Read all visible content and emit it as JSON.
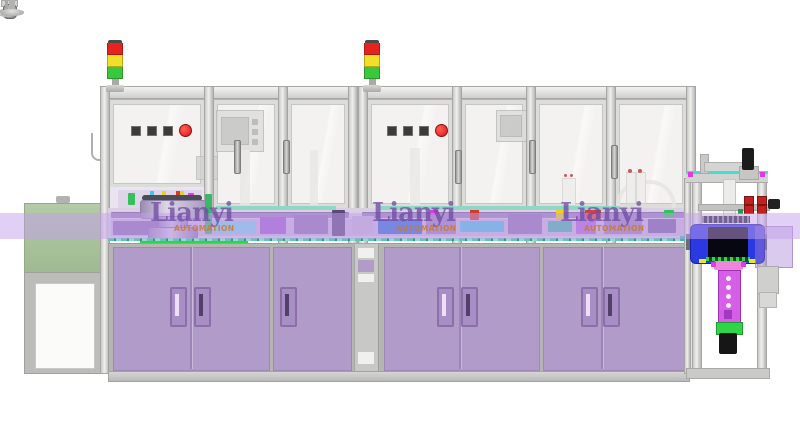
{
  "scene": {
    "description": "3D CAD render of a two-module enclosed automation assembly line: twin red-yellow-green signal towers, glass safety doors with pushbutton panels, vibratory bowl feeder, purple lower cabinets on leveling feet and casters, a left outfeed conveyor cabinet and a right camera inspection station"
  },
  "watermark": {
    "brand": "Lianyi",
    "subtitle": "AUTOMATION",
    "instances": [
      {
        "x": 150,
        "y": 200
      },
      {
        "x": 372,
        "y": 200
      },
      {
        "x": 560,
        "y": 200
      }
    ]
  },
  "palette": {
    "frame_dark": "#a6a6a4",
    "glass": "#f3f2f0",
    "cabinet_purple": "#b19cc9",
    "cabinet_border": "#9d88b6",
    "handle_light": "#eedff8",
    "handle_dark": "#52406b",
    "handle_frame": "#8a6fa8",
    "green_cabinet": "#aac19d",
    "signal_red": "#e6231d",
    "signal_yellow": "#f2e028",
    "signal_green": "#3cc83c",
    "button_dark": "#3b3b3b",
    "button_red": "#e01414",
    "green_line": "#2fd546",
    "band_overlay": "rgba(196,160,235,0.5)",
    "fixture_blue": "#2b3ae0",
    "fixture_core": "#07070f",
    "bracket_magenta": "#d55fe6",
    "bracket_pink": "#ef86dc",
    "lens_black": "#161616",
    "plate_cyan": "#44ddcf",
    "knob_red": "#c32020",
    "watermark_purple": "rgba(108,74,160,0.75)",
    "watermark_orange": "rgba(200,122,44,0.85)"
  },
  "signal_tower_segments": [
    "signal_red",
    "signal_yellow",
    "signal_green"
  ],
  "control_panel": {
    "square_button_count": 3,
    "has_red_button": true
  },
  "machinery_blocks": [
    {
      "x": 111,
      "y": 212,
      "w": 238,
      "h": 6,
      "c": "#9a82bd"
    },
    {
      "x": 362,
      "y": 212,
      "w": 322,
      "h": 6,
      "c": "#9a82bd"
    },
    {
      "x": 111,
      "y": 219,
      "w": 575,
      "h": 17,
      "c": "#cabadd"
    },
    {
      "x": 113,
      "y": 221,
      "w": 52,
      "h": 14,
      "c": "#8e74b2"
    },
    {
      "x": 205,
      "y": 194,
      "w": 7,
      "h": 40,
      "c": "#38b868"
    },
    {
      "x": 214,
      "y": 221,
      "w": 42,
      "h": 13,
      "c": "#79d6e6"
    },
    {
      "x": 260,
      "y": 217,
      "w": 26,
      "h": 17,
      "c": "#a05ed2"
    },
    {
      "x": 294,
      "y": 215,
      "w": 34,
      "h": 19,
      "c": "#8e74b2"
    },
    {
      "x": 332,
      "y": 210,
      "w": 13,
      "h": 26,
      "c": "#5a4a7a"
    },
    {
      "x": 352,
      "y": 216,
      "w": 22,
      "h": 18,
      "c": "#c2b4d6"
    },
    {
      "x": 378,
      "y": 219,
      "w": 44,
      "h": 15,
      "c": "#2f6fd8"
    },
    {
      "x": 426,
      "y": 213,
      "w": 30,
      "h": 21,
      "c": "#9a82bd"
    },
    {
      "x": 430,
      "y": 208,
      "w": 8,
      "h": 7,
      "c": "#e23ae2"
    },
    {
      "x": 460,
      "y": 221,
      "w": 44,
      "h": 11,
      "c": "#49c4e4"
    },
    {
      "x": 470,
      "y": 209,
      "w": 9,
      "h": 11,
      "c": "#d23b30"
    },
    {
      "x": 508,
      "y": 214,
      "w": 34,
      "h": 20,
      "c": "#8e74b2"
    },
    {
      "x": 548,
      "y": 221,
      "w": 24,
      "h": 11,
      "c": "#3fb8a8"
    },
    {
      "x": 556,
      "y": 210,
      "w": 8,
      "h": 9,
      "c": "#efd020"
    },
    {
      "x": 576,
      "y": 214,
      "w": 20,
      "h": 20,
      "c": "#b06ad8"
    },
    {
      "x": 585,
      "y": 209,
      "w": 16,
      "h": 10,
      "c": "#d84040"
    },
    {
      "x": 604,
      "y": 216,
      "w": 38,
      "h": 18,
      "c": "#9a82bd"
    },
    {
      "x": 648,
      "y": 219,
      "w": 28,
      "h": 14,
      "c": "#7a62a2"
    },
    {
      "x": 664,
      "y": 210,
      "w": 10,
      "h": 8,
      "c": "#35c05a"
    },
    {
      "x": 118,
      "y": 190,
      "w": 84,
      "h": 18,
      "c": "#ded5ea"
    },
    {
      "x": 128,
      "y": 193,
      "w": 7,
      "h": 12,
      "c": "#35c05a"
    },
    {
      "x": 178,
      "y": 191,
      "w": 6,
      "h": 6,
      "c": "#efd020"
    },
    {
      "x": 188,
      "y": 193,
      "w": 6,
      "h": 6,
      "c": "#e23ae2"
    },
    {
      "x": 216,
      "y": 206,
      "w": 120,
      "h": 4,
      "c": "#8fd8c8"
    },
    {
      "x": 380,
      "y": 206,
      "w": 240,
      "h": 4,
      "c": "#8fd8c8"
    }
  ],
  "feet": {
    "machine_feet_x": [
      120,
      222,
      310,
      385,
      470,
      592,
      648,
      681
    ],
    "caster_x": [
      152,
      338,
      415,
      515,
      612
    ],
    "left_cabinet_feet_x": [
      42,
      88
    ],
    "station_feet_x": [
      702,
      748
    ]
  }
}
